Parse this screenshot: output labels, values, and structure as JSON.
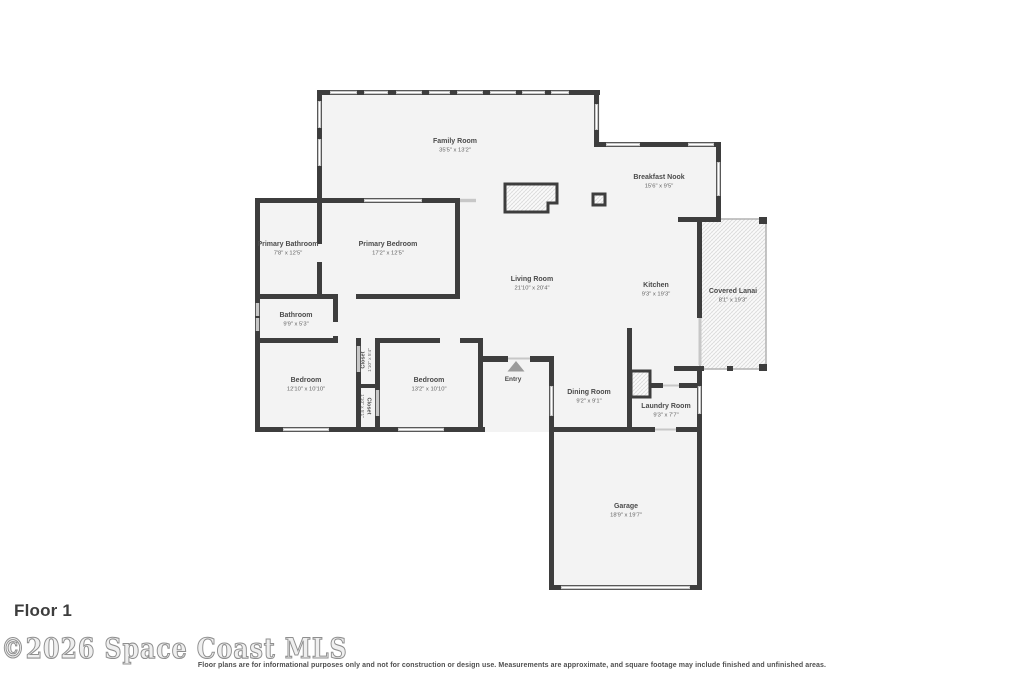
{
  "title": {
    "floor_label": "Floor 1"
  },
  "footer": {
    "watermark": "©2026 Space Coast MLS",
    "disclaimer": "Floor plans are for informational purposes only and not for construction or design use. Measurements are approximate, and square footage may include finished and unfinished areas."
  },
  "rooms": {
    "family_room": {
      "name": "Family Room",
      "dims": "35'5\" x 13'2\""
    },
    "breakfast_nook": {
      "name": "Breakfast Nook",
      "dims": "15'6\" x 9'5\""
    },
    "primary_bathroom": {
      "name": "Primary Bathroom",
      "dims": "7'8\" x 12'5\""
    },
    "primary_bedroom": {
      "name": "Primary Bedroom",
      "dims": "17'2\" x 12'5\""
    },
    "living_room": {
      "name": "Living Room",
      "dims": "21'10\" x 20'4\""
    },
    "kitchen": {
      "name": "Kitchen",
      "dims": "9'3\" x 19'3\""
    },
    "covered_lanai": {
      "name": "Covered Lanai",
      "dims": "8'1\" x 19'3\""
    },
    "bathroom": {
      "name": "Bathroom",
      "dims": "9'9\" x 5'3\""
    },
    "bedroom_left": {
      "name": "Bedroom",
      "dims": "12'10\" x 10'10\""
    },
    "bedroom_right": {
      "name": "Bedroom",
      "dims": "13'2\" x 10'10\""
    },
    "closet_upper": {
      "name": "Closet",
      "dims": "1'10\" x 5'4\""
    },
    "closet_lower": {
      "name": "Closet",
      "dims": "1'10\" x 5'1\""
    },
    "entry": {
      "name": "Entry"
    },
    "dining_room": {
      "name": "Dining Room",
      "dims": "9'2\" x 9'1\""
    },
    "laundry_room": {
      "name": "Laundry Room",
      "dims": "9'3\" x 7'7\""
    },
    "garage": {
      "name": "Garage",
      "dims": "18'9\" x 19'7\""
    }
  },
  "colors": {
    "wall": "#3d3d3d",
    "floor": "#f3f3f3",
    "window": "#c7c7c7",
    "label": "#4b4b4b",
    "watermark": "#8f8f8f"
  }
}
